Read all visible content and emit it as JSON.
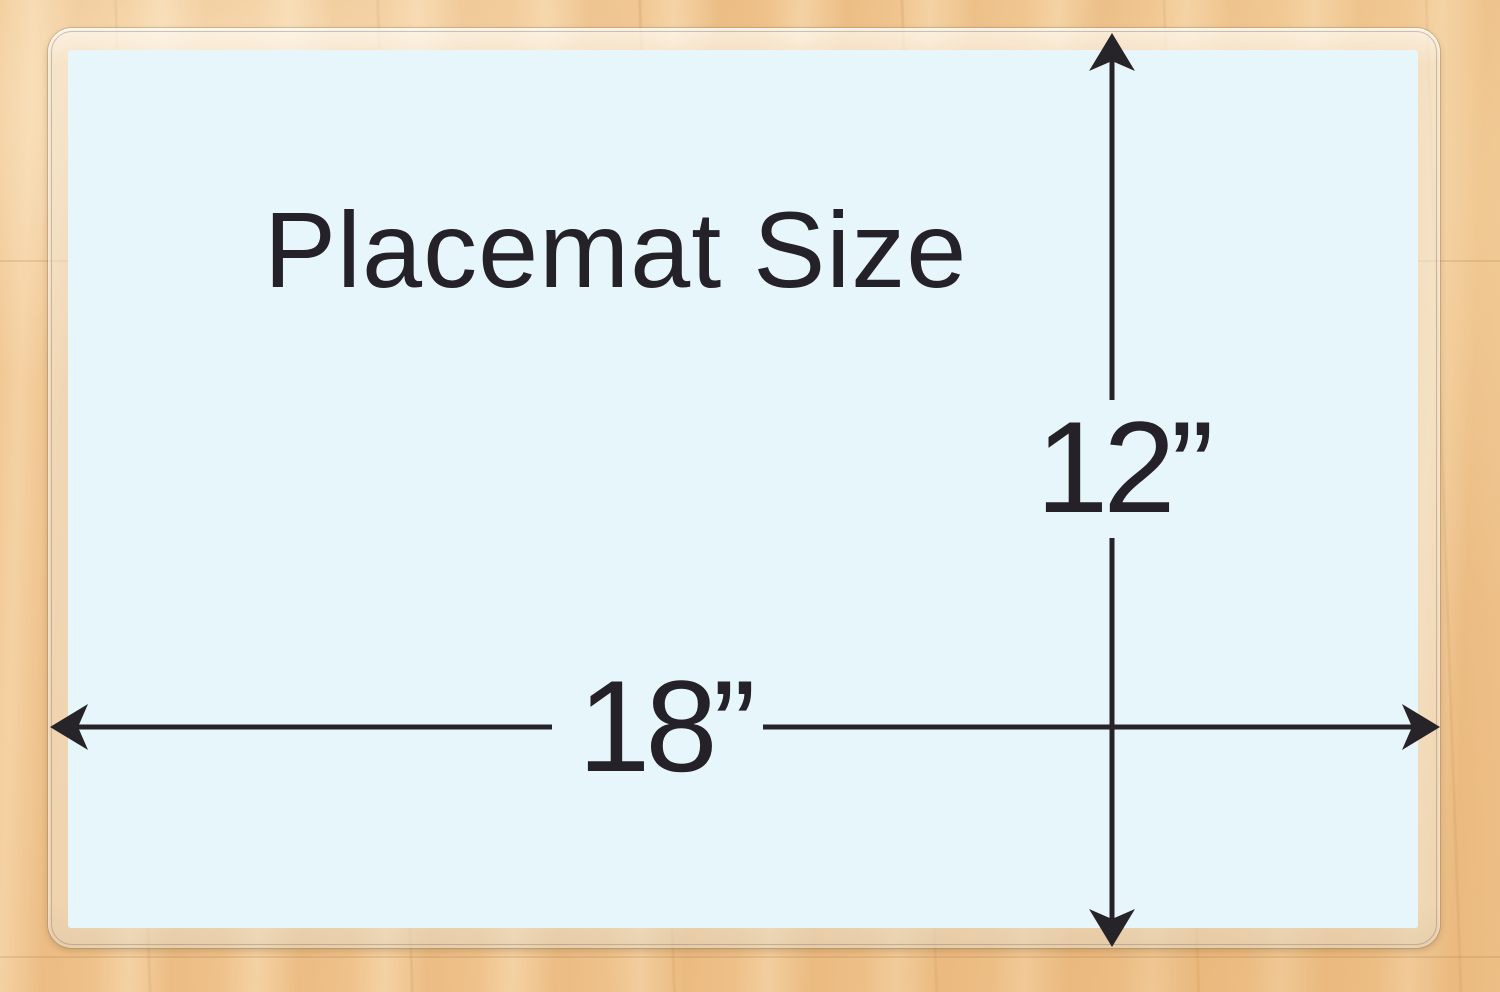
{
  "diagram": {
    "title": "Placemat Size",
    "height_label": "12”",
    "width_label": "18”"
  },
  "icons": {
    "arrow_up": "arrowhead pointing up (barbed)",
    "arrow_down": "arrowhead pointing down (barbed)",
    "arrow_left": "arrowhead pointing left (barbed)",
    "arrow_right": "arrowhead pointing right (barbed)"
  },
  "colors": {
    "placemat_fill": "#e7f6fb",
    "dimension_line": "#262329",
    "text": "#242128",
    "wood_base": "#efc28b",
    "laminate_edge": "#f4ecde"
  }
}
